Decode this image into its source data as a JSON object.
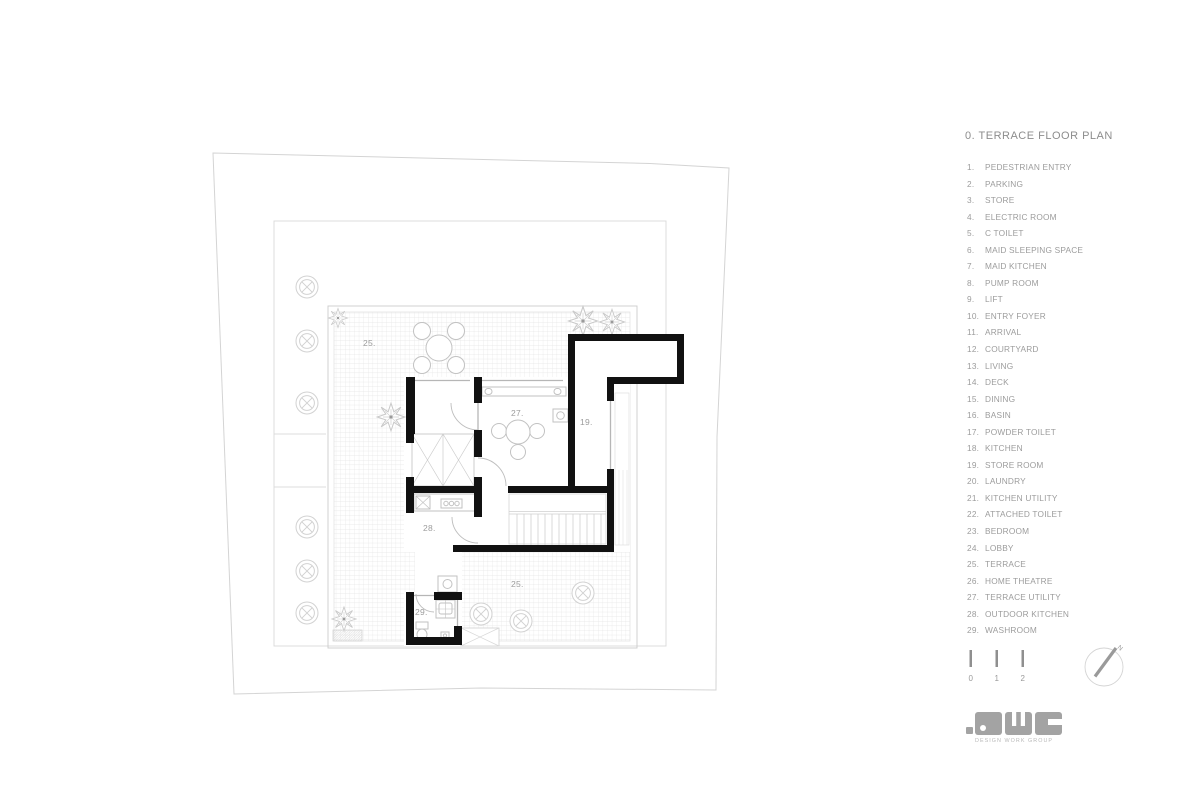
{
  "title": "0. TERRACE FLOOR PLAN",
  "legend": {
    "items": [
      {
        "num": "1.",
        "label": "PEDESTRIAN ENTRY"
      },
      {
        "num": "2.",
        "label": "PARKING"
      },
      {
        "num": "3.",
        "label": "STORE"
      },
      {
        "num": "4.",
        "label": "ELECTRIC ROOM"
      },
      {
        "num": "5.",
        "label": "C TOILET"
      },
      {
        "num": "6.",
        "label": "MAID SLEEPING SPACE"
      },
      {
        "num": "7.",
        "label": "MAID KITCHEN"
      },
      {
        "num": "8.",
        "label": "PUMP ROOM"
      },
      {
        "num": "9.",
        "label": "LIFT"
      },
      {
        "num": "10.",
        "label": "ENTRY FOYER"
      },
      {
        "num": "11.",
        "label": "ARRIVAL"
      },
      {
        "num": "12.",
        "label": "COURTYARD"
      },
      {
        "num": "13.",
        "label": "LIVING"
      },
      {
        "num": "14.",
        "label": "DECK"
      },
      {
        "num": "15.",
        "label": "DINING"
      },
      {
        "num": "16.",
        "label": "BASIN"
      },
      {
        "num": "17.",
        "label": "POWDER TOILET"
      },
      {
        "num": "18.",
        "label": "KITCHEN"
      },
      {
        "num": "19.",
        "label": "STORE ROOM"
      },
      {
        "num": "20.",
        "label": "LAUNDRY"
      },
      {
        "num": "21.",
        "label": "KITCHEN UTILITY"
      },
      {
        "num": "22.",
        "label": "ATTACHED TOILET"
      },
      {
        "num": "23.",
        "label": "BEDROOM"
      },
      {
        "num": "24.",
        "label": "LOBBY"
      },
      {
        "num": "25.",
        "label": "TERRACE"
      },
      {
        "num": "26.",
        "label": "HOME THEATRE"
      },
      {
        "num": "27.",
        "label": "TERRACE UTILITY"
      },
      {
        "num": "28.",
        "label": "OUTDOOR KITCHEN"
      },
      {
        "num": "29.",
        "label": "WASHROOM"
      }
    ]
  },
  "plan": {
    "labels": {
      "terrace_top": "25.",
      "terrace_utility": "27.",
      "store_room": "19.",
      "outdoor_kitchen": "28.",
      "terrace_bottom": "25.",
      "washroom": "29."
    }
  },
  "scale_bar": {
    "ticks": [
      "0",
      "1",
      "2"
    ]
  },
  "north": {
    "label": "N"
  },
  "logo": {
    "text": "DWG",
    "subtitle": "DESIGN WORK GROUP"
  },
  "colors": {
    "wall": "#111111",
    "boundary": "#d4d4d4",
    "hatch": "#e4e4e4",
    "furniture": "#c2c2c2",
    "label_text": "#9c9c9c",
    "logo_gray": "#a3a3a3"
  }
}
